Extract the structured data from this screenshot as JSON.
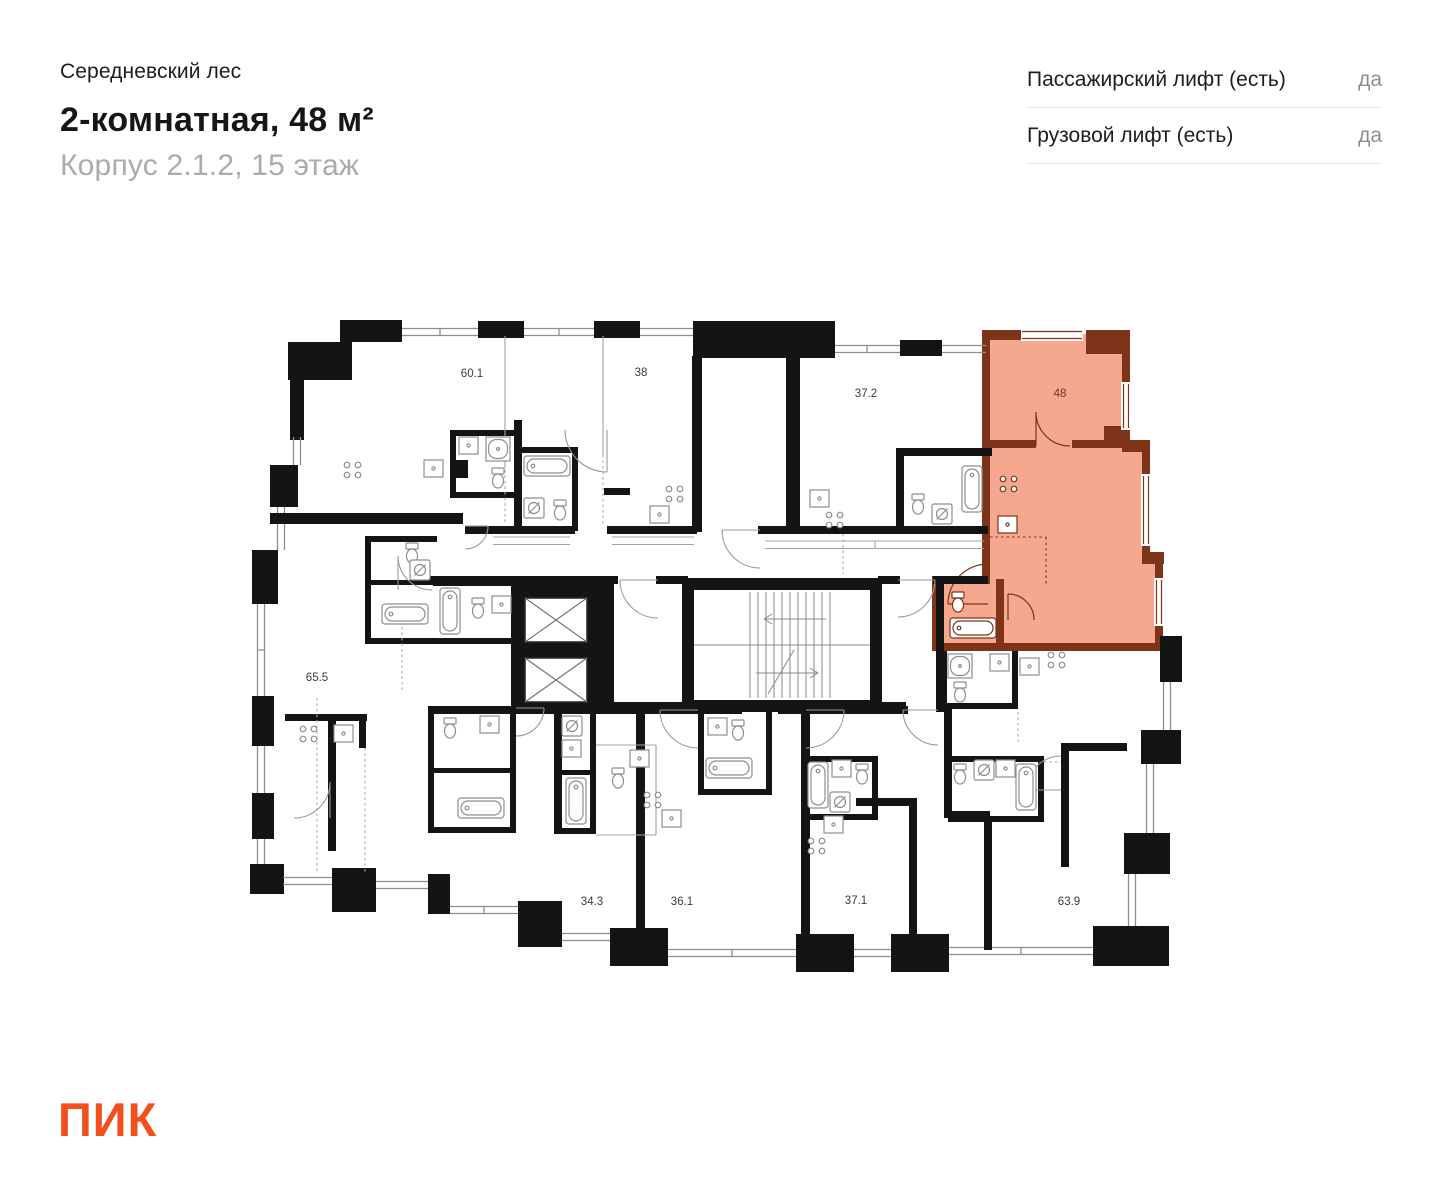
{
  "header": {
    "project": "Середневский лес",
    "title": "2-комнатная, 48 м²",
    "subtitle": "Корпус 2.1.2, 15 этаж"
  },
  "amenities": {
    "rows": [
      {
        "label": "Пассажирский лифт (есть)",
        "value": "да"
      },
      {
        "label": "Грузовой лифт (есть)",
        "value": "да"
      }
    ]
  },
  "logo": {
    "text": "ПИК",
    "color": "#F4501E"
  },
  "plan": {
    "highlight": {
      "unit_area": "48",
      "fill": "#F6A78F",
      "wall_color": "#7D3419"
    },
    "label_color": "#3A3A3A",
    "area_labels": [
      {
        "text": "60.1",
        "x": 472,
        "y": 377,
        "highlight": false
      },
      {
        "text": "38",
        "x": 641,
        "y": 376,
        "highlight": false
      },
      {
        "text": "37.2",
        "x": 866,
        "y": 397,
        "highlight": false
      },
      {
        "text": "48",
        "x": 1060,
        "y": 397,
        "highlight": true
      },
      {
        "text": "65.5",
        "x": 317,
        "y": 681,
        "highlight": false
      },
      {
        "text": "34.3",
        "x": 592,
        "y": 905,
        "highlight": false
      },
      {
        "text": "36.1",
        "x": 682,
        "y": 905,
        "highlight": false
      },
      {
        "text": "37.1",
        "x": 856,
        "y": 904,
        "highlight": false
      },
      {
        "text": "63.9",
        "x": 1069,
        "y": 905,
        "highlight": false
      }
    ]
  }
}
